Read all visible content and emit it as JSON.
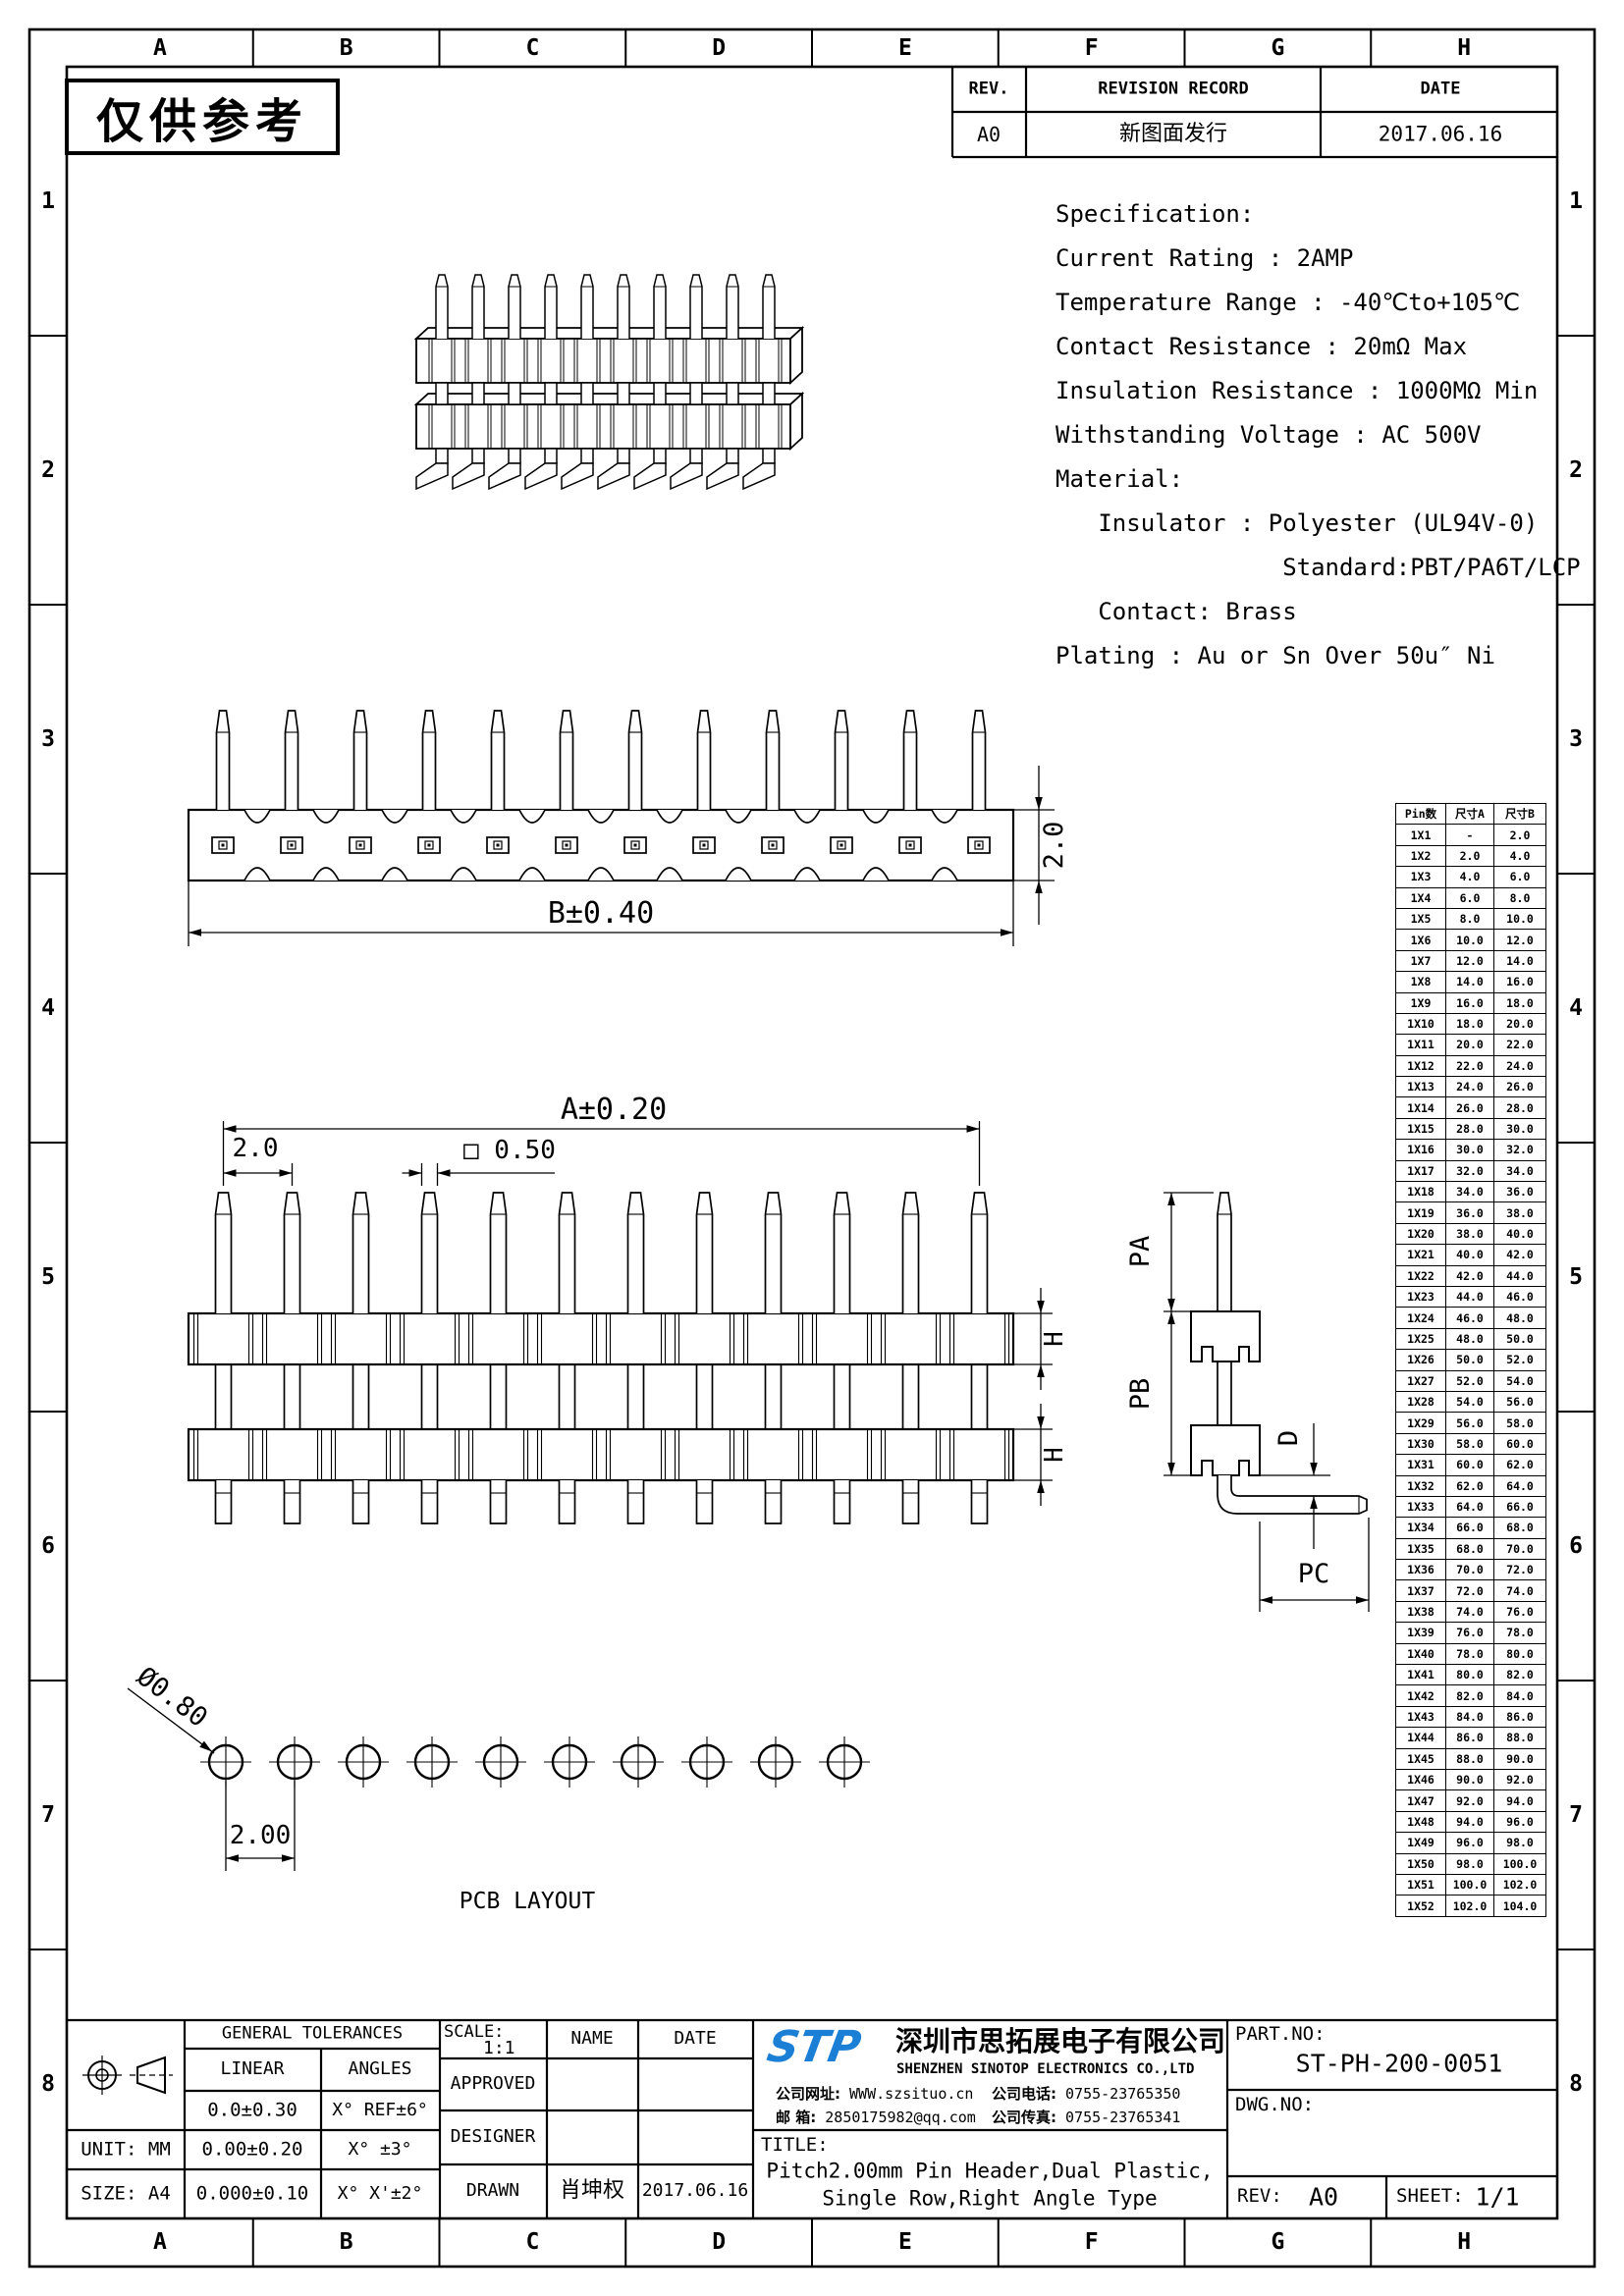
{
  "watermark": "仅供参考",
  "grid": {
    "columns": [
      "A",
      "B",
      "C",
      "D",
      "E",
      "F",
      "G",
      "H"
    ],
    "rows": [
      "1",
      "2",
      "3",
      "4",
      "5",
      "6",
      "7",
      "8"
    ]
  },
  "revision_table": {
    "headers": [
      "REV.",
      "REVISION RECORD",
      "DATE"
    ],
    "rows": [
      [
        "A0",
        "新图面发行",
        "2017.06.16"
      ]
    ]
  },
  "specification_lines": [
    "Specification:",
    "Current Rating : 2AMP",
    "Temperature Range : -40℃to+105℃",
    "Contact Resistance : 20mΩ Max",
    "Insulation Resistance : 1000MΩ Min",
    "Withstanding Voltage : AC 500V",
    "Material:",
    "   Insulator : Polyester (UL94V-0)",
    "                Standard:PBT/PA6T/LCP",
    "   Contact: Brass",
    "Plating : Au or Sn Over 50u″ Ni"
  ],
  "drawings": {
    "iso_view": {
      "pin_count": 10
    },
    "top_view": {
      "pin_count": 12,
      "dim_b": "B±0.40",
      "dim_h": "2.0"
    },
    "front_view": {
      "pin_count": 12,
      "dim_a": "A±0.20",
      "dim_pitch": "2.0",
      "dim_sq": "□ 0.50",
      "dim_h": "H"
    },
    "side_view": {
      "labels": {
        "pa": "PA",
        "pb": "PB",
        "d": "D",
        "pc": "PC"
      }
    },
    "pcb_layout": {
      "hole_count": 10,
      "dim_dia": "Ø0.80",
      "dim_pitch": "2.00",
      "caption": "PCB LAYOUT"
    }
  },
  "pin_table": {
    "headers": [
      "Pin数",
      "尺寸A",
      "尺寸B"
    ],
    "rows": [
      [
        "1X1",
        "-",
        "2.0"
      ],
      [
        "1X2",
        "2.0",
        "4.0"
      ],
      [
        "1X3",
        "4.0",
        "6.0"
      ],
      [
        "1X4",
        "6.0",
        "8.0"
      ],
      [
        "1X5",
        "8.0",
        "10.0"
      ],
      [
        "1X6",
        "10.0",
        "12.0"
      ],
      [
        "1X7",
        "12.0",
        "14.0"
      ],
      [
        "1X8",
        "14.0",
        "16.0"
      ],
      [
        "1X9",
        "16.0",
        "18.0"
      ],
      [
        "1X10",
        "18.0",
        "20.0"
      ],
      [
        "1X11",
        "20.0",
        "22.0"
      ],
      [
        "1X12",
        "22.0",
        "24.0"
      ],
      [
        "1X13",
        "24.0",
        "26.0"
      ],
      [
        "1X14",
        "26.0",
        "28.0"
      ],
      [
        "1X15",
        "28.0",
        "30.0"
      ],
      [
        "1X16",
        "30.0",
        "32.0"
      ],
      [
        "1X17",
        "32.0",
        "34.0"
      ],
      [
        "1X18",
        "34.0",
        "36.0"
      ],
      [
        "1X19",
        "36.0",
        "38.0"
      ],
      [
        "1X20",
        "38.0",
        "40.0"
      ],
      [
        "1X21",
        "40.0",
        "42.0"
      ],
      [
        "1X22",
        "42.0",
        "44.0"
      ],
      [
        "1X23",
        "44.0",
        "46.0"
      ],
      [
        "1X24",
        "46.0",
        "48.0"
      ],
      [
        "1X25",
        "48.0",
        "50.0"
      ],
      [
        "1X26",
        "50.0",
        "52.0"
      ],
      [
        "1X27",
        "52.0",
        "54.0"
      ],
      [
        "1X28",
        "54.0",
        "56.0"
      ],
      [
        "1X29",
        "56.0",
        "58.0"
      ],
      [
        "1X30",
        "58.0",
        "60.0"
      ],
      [
        "1X31",
        "60.0",
        "62.0"
      ],
      [
        "1X32",
        "62.0",
        "64.0"
      ],
      [
        "1X33",
        "64.0",
        "66.0"
      ],
      [
        "1X34",
        "66.0",
        "68.0"
      ],
      [
        "1X35",
        "68.0",
        "70.0"
      ],
      [
        "1X36",
        "70.0",
        "72.0"
      ],
      [
        "1X37",
        "72.0",
        "74.0"
      ],
      [
        "1X38",
        "74.0",
        "76.0"
      ],
      [
        "1X39",
        "76.0",
        "78.0"
      ],
      [
        "1X40",
        "78.0",
        "80.0"
      ],
      [
        "1X41",
        "80.0",
        "82.0"
      ],
      [
        "1X42",
        "82.0",
        "84.0"
      ],
      [
        "1X43",
        "84.0",
        "86.0"
      ],
      [
        "1X44",
        "86.0",
        "88.0"
      ],
      [
        "1X45",
        "88.0",
        "90.0"
      ],
      [
        "1X46",
        "90.0",
        "92.0"
      ],
      [
        "1X47",
        "92.0",
        "94.0"
      ],
      [
        "1X48",
        "94.0",
        "96.0"
      ],
      [
        "1X49",
        "96.0",
        "98.0"
      ],
      [
        "1X50",
        "98.0",
        "100.0"
      ],
      [
        "1X51",
        "100.0",
        "102.0"
      ],
      [
        "1X52",
        "102.0",
        "104.0"
      ]
    ]
  },
  "title_block": {
    "general_tolerances": {
      "title": "GENERAL TOLERANCES",
      "linear_header": "LINEAR",
      "angles_header": "ANGLES",
      "linear": [
        "0.0±0.30",
        "0.00±0.20",
        "0.000±0.10"
      ],
      "angles": [
        "X° REF±6°",
        "X° ±3°",
        "X° X'±2°"
      ]
    },
    "unit_label": "UNIT: MM",
    "size_label": "SIZE: A4",
    "scale_label": "SCALE:",
    "scale_value": "1:1",
    "name_header": "NAME",
    "date_header": "DATE",
    "approved_label": "APPROVED",
    "designer_label": "DESIGNER",
    "drawn_label": "DRAWN",
    "drawn_name": "肖坤权",
    "drawn_date": "2017.06.16",
    "company": {
      "logo": "STP",
      "logo_color": "#1b7fd6",
      "name_cn": "深圳市思拓展电子有限公司",
      "name_en": "SHENZHEN SINOTOP ELECTRONICS CO.,LTD",
      "website_label": "公司网址:",
      "website": "WWW.szsituo.cn",
      "email_label": "邮  箱:",
      "email": "2850175982@qq.com",
      "phone_label": "公司电话:",
      "phone": "0755-23765350",
      "fax_label": "公司传真:",
      "fax": "0755-23765341"
    },
    "title_label": "TITLE:",
    "title_line1": "Pitch2.00mm Pin Header,Dual Plastic,",
    "title_line2": "Single Row,Right Angle Type",
    "part_no_label": "PART.NO:",
    "part_no": "ST-PH-200-0051",
    "dwg_no_label": "DWG.NO:",
    "rev_label": "REV:",
    "rev": "A0",
    "sheet_label": "SHEET:",
    "sheet": "1/1"
  }
}
